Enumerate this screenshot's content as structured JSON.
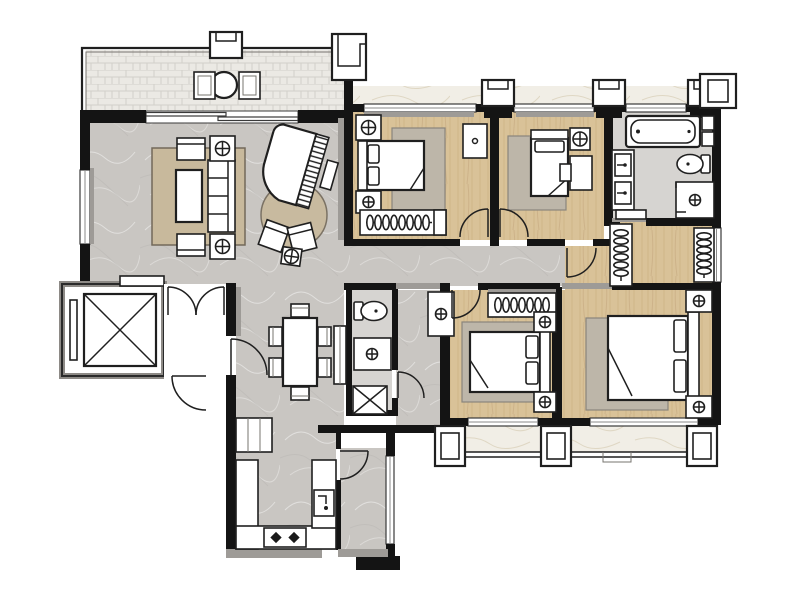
{
  "meta": {
    "title": "Apartment floor plan (4 bedrooms, hand-rendered)",
    "canvas": {
      "width": 800,
      "height": 600
    }
  },
  "palette": {
    "background": "#ffffff",
    "wall": "#141414",
    "wallgray": "#9e9b97",
    "marble": "#c9c6c2",
    "marblelight": "#d6d4d1",
    "wood": "#d9c298",
    "woodlight": "#e2d0ac",
    "tile": "#ebe9e4",
    "whitemarble": "#f1eee6",
    "rug": "#c8b99c",
    "rug2": "#bdb6a9",
    "line": "#1f1f1f",
    "fixture": "#ffffff"
  },
  "rooms": [
    {
      "id": "terrace-balcony",
      "floor": "tile",
      "furniture": [
        "round-table",
        "chair",
        "chair"
      ]
    },
    {
      "id": "living-room",
      "floor": "marble",
      "furniture": [
        "area-rug",
        "sofa",
        "coffee-table",
        "armchair",
        "armchair",
        "plant-stand",
        "plant-stand",
        "grand-piano",
        "piano-bench",
        "round-rug",
        "lounge-chair",
        "lounge-chair",
        "tea-table"
      ]
    },
    {
      "id": "dining-room",
      "floor": "marble",
      "furniture": [
        "dining-table",
        "chair",
        "chair",
        "chair",
        "chair",
        "chair",
        "chair",
        "tall-cabinet",
        "shoe-cabinet"
      ]
    },
    {
      "id": "foyer-elevator-lobby",
      "floor": "none",
      "furniture": [
        "elevator",
        "double-swing-door",
        "entry-door"
      ]
    },
    {
      "id": "kitchen",
      "floor": "marble",
      "furniture": [
        "l-shaped-counter",
        "cooktop-two-burner",
        "sink"
      ]
    },
    {
      "id": "utility-balcony",
      "floor": "marble",
      "furniture": []
    },
    {
      "id": "guest-bathroom",
      "floor": "marble-light",
      "furniture": [
        "toilet",
        "shower",
        "utility-shaft"
      ]
    },
    {
      "id": "hallway",
      "floor": "marble",
      "furniture": [
        "vanity-sink"
      ]
    },
    {
      "id": "bedroom-1",
      "floor": "wood",
      "furniture": [
        "double-bed",
        "nightstand",
        "nightstand",
        "area-rug",
        "wardrobe-with-hangers",
        "dresser"
      ]
    },
    {
      "id": "bedroom-2",
      "floor": "wood",
      "furniture": [
        "double-bed",
        "nightstand",
        "desk",
        "chair",
        "area-rug"
      ]
    },
    {
      "id": "bedroom-3",
      "floor": "wood",
      "furniture": [
        "double-bed",
        "nightstand",
        "nightstand",
        "area-rug",
        "wardrobe-with-hangers"
      ]
    },
    {
      "id": "master-bedroom",
      "floor": "wood",
      "furniture": [
        "king-bed",
        "nightstand",
        "nightstand",
        "area-rug"
      ]
    },
    {
      "id": "master-bathroom",
      "floor": "marble-light",
      "furniture": [
        "bathtub",
        "toilet",
        "shower",
        "double-vanity",
        "bench"
      ]
    },
    {
      "id": "walk-in-closet",
      "floor": "wood",
      "furniture": [
        "wardrobe-with-hangers",
        "wardrobe-with-hangers"
      ]
    },
    {
      "id": "rear-balcony",
      "floor": "white-marble",
      "furniture": []
    }
  ]
}
